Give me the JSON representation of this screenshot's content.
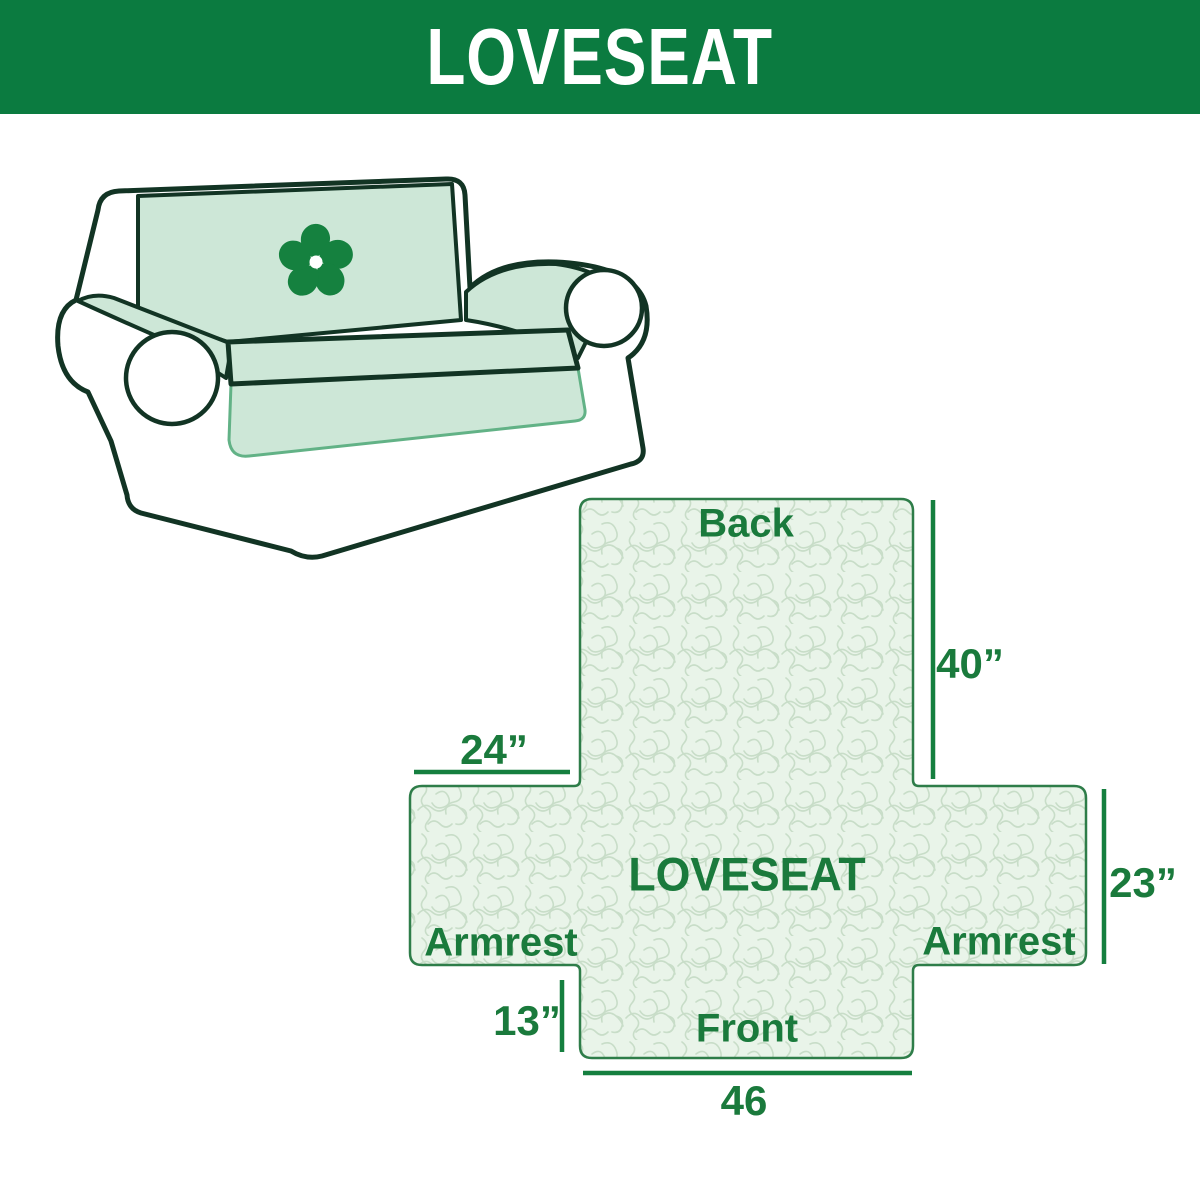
{
  "banner": {
    "title": "LOVESEAT",
    "bg_color": "#0b7b40",
    "text_color": "#ffffff"
  },
  "illustration": {
    "subject": "loveseat sofa with slipcover",
    "cover_color": "#cde7d7",
    "outline_color": "#123424",
    "logo_icon": "pinwheel-icon",
    "logo_color": "#15813f"
  },
  "diagram": {
    "back_label": "Back",
    "front_label": "Front",
    "center_label": "LOVESEAT",
    "armrest_left_label": "Armrest",
    "armrest_right_label": "Armrest",
    "back_height": "40”",
    "armrest_width": "24”",
    "side_height": "23”",
    "front_height": "13”",
    "front_width": "46",
    "fill_color": "#e9f4e9",
    "pattern_line_color": "#c8ddc8",
    "border_color": "#2e7d49",
    "dimension_line_color": "#157f3f",
    "text_color": "#1a7a3c"
  }
}
